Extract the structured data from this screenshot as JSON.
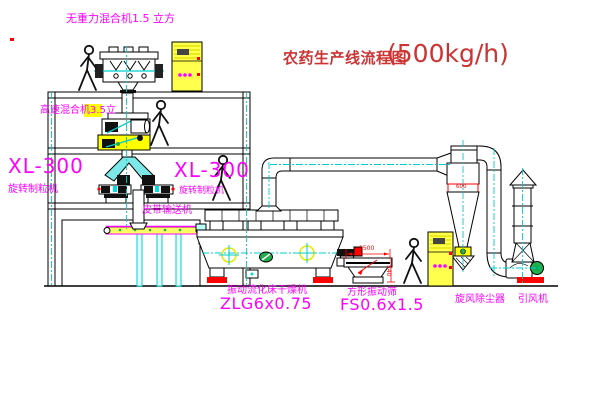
{
  "title": {
    "text": "农药生产线流程图",
    "capacity": "(500kg/h)"
  },
  "equipment": {
    "top_mixer": "无重力混合机1.5 立方",
    "mid_mixer": "高速混合机3.5立",
    "granulator_left": {
      "model": "XL-300",
      "name": "旋转制粒机"
    },
    "granulator_right": {
      "model": "XL-300",
      "name": "旋转制粒机"
    },
    "belt_conveyor": "皮带输送机",
    "dryer": {
      "name": "振动流化床干燥机",
      "model": "ZLG6x0.75"
    },
    "screen": {
      "name": "方形振动筛",
      "model": "FS0.6x1.5"
    },
    "cyclone": "旋风除尘器",
    "fan": "引风机"
  },
  "dimensions": {
    "screen_length": "1500",
    "screen_height": "540",
    "cyclone_diameter": "600"
  },
  "colors": {
    "label": "#ff00ff",
    "title": "#cc3333",
    "line": "#000000",
    "centerline": "#00cccc",
    "highlight": "#ffff00",
    "accent": "#ff0000"
  }
}
